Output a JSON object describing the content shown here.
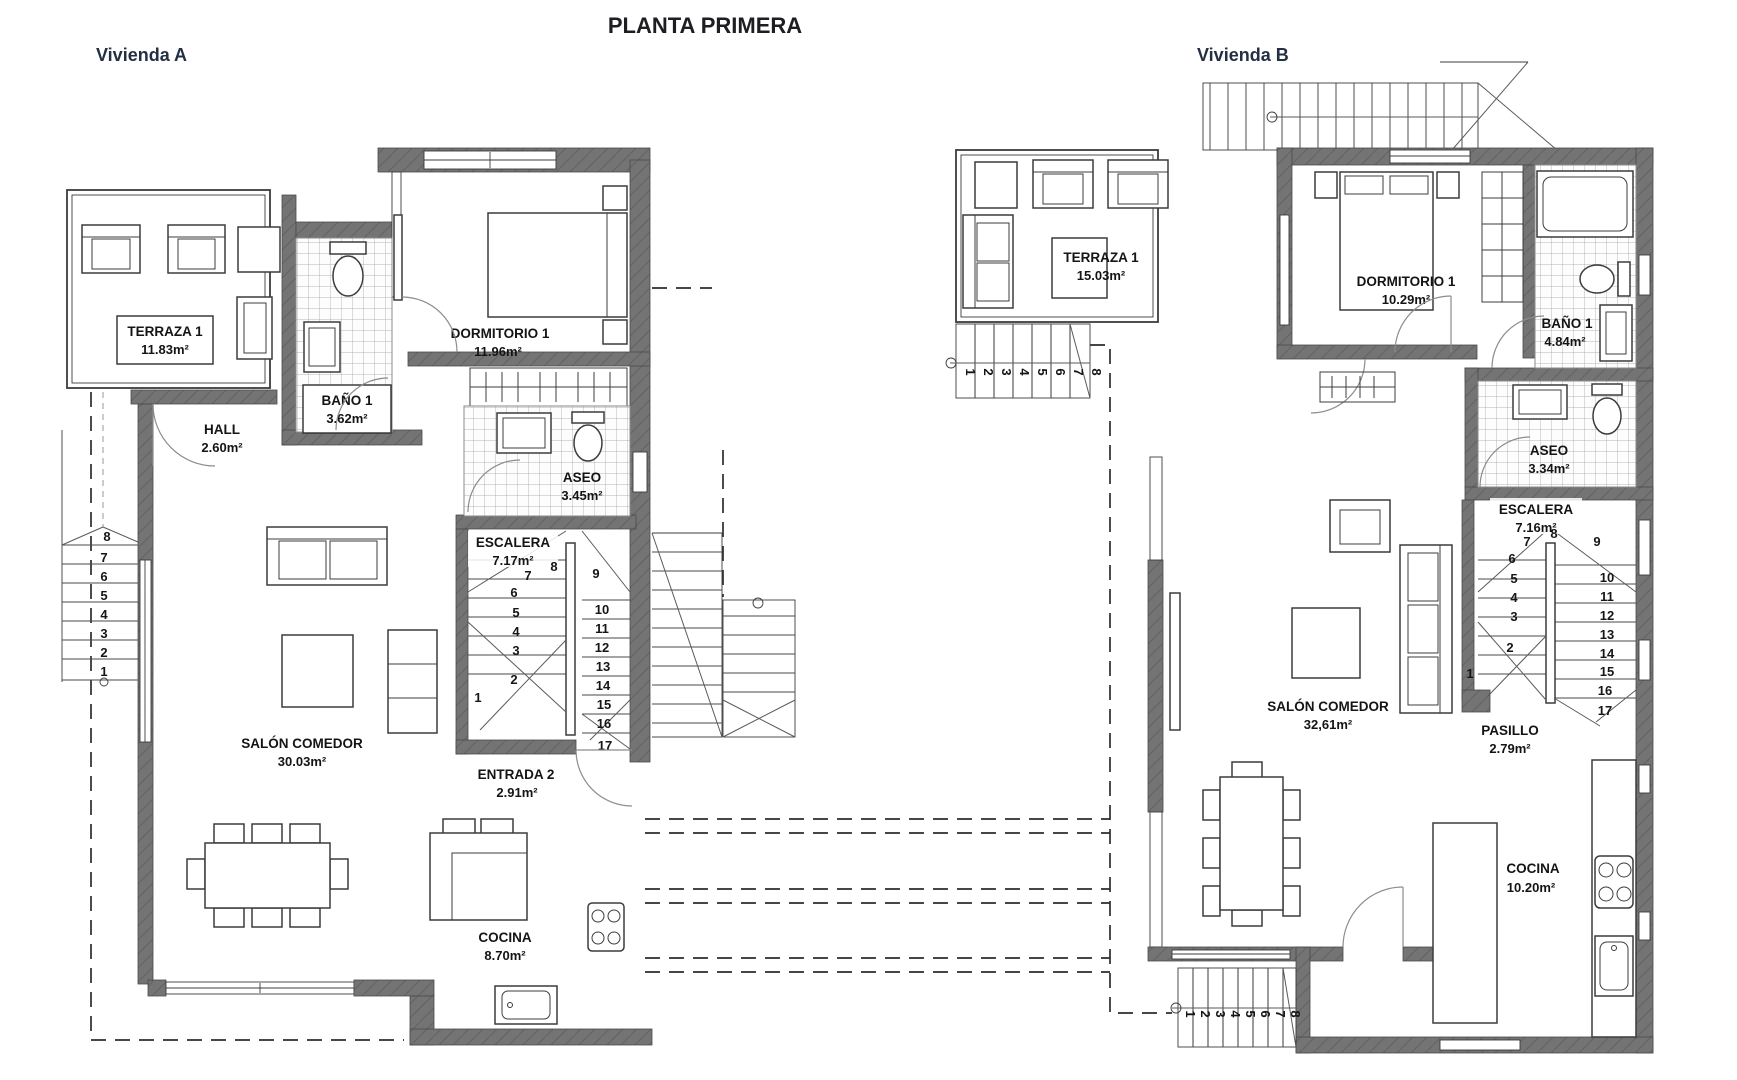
{
  "title": "PLANTA PRIMERA",
  "colors": {
    "wall": "#737373",
    "line": "#3c3c3c",
    "dwelling_label": "#233043"
  },
  "vivienda_a": {
    "name": "Vivienda A",
    "rooms": {
      "terraza": {
        "name": "TERRAZA 1",
        "area": "11.83m²"
      },
      "bano1": {
        "name": "BAÑO 1",
        "area": "3.62m²"
      },
      "dormitorio1": {
        "name": "DORMITORIO 1",
        "area": "11.96m²"
      },
      "hall": {
        "name": "HALL",
        "area": "2.60m²"
      },
      "aseo": {
        "name": "ASEO",
        "area": "3.45m²"
      },
      "escalera": {
        "name": "ESCALERA",
        "area": "7.17m²"
      },
      "salon_comedor": {
        "name": "SALÓN COMEDOR",
        "area": "30.03m²"
      },
      "entrada2": {
        "name": "ENTRADA 2",
        "area": "2.91m²"
      },
      "cocina": {
        "name": "COCINA",
        "area": "8.70m²"
      }
    },
    "stairs": {
      "interior": [
        "1",
        "2",
        "3",
        "4",
        "5",
        "6",
        "7",
        "8",
        "9",
        "10",
        "11",
        "12",
        "13",
        "14",
        "15",
        "16",
        "17"
      ],
      "exterior": [
        "1",
        "2",
        "3",
        "4",
        "5",
        "6",
        "7",
        "8"
      ]
    }
  },
  "vivienda_b": {
    "name": "Vivienda B",
    "rooms": {
      "terraza": {
        "name": "TERRAZA 1",
        "area": "15.03m²"
      },
      "dormitorio1": {
        "name": "DORMITORIO 1",
        "area": "10.29m²"
      },
      "bano1": {
        "name": "BAÑO 1",
        "area": "4.84m²"
      },
      "aseo": {
        "name": "ASEO",
        "area": "3.34m²"
      },
      "escalera": {
        "name": "ESCALERA",
        "area": "7.16m²"
      },
      "salon_comedor": {
        "name": "SALÓN COMEDOR",
        "area": "32,61m²"
      },
      "pasillo": {
        "name": "PASILLO",
        "area": "2.79m²"
      },
      "cocina": {
        "name": "COCINA",
        "area": "10.20m²"
      }
    },
    "stairs": {
      "interior": [
        "1",
        "2",
        "3",
        "4",
        "5",
        "6",
        "7",
        "8",
        "9",
        "10",
        "11",
        "12",
        "13",
        "14",
        "15",
        "16",
        "17"
      ],
      "terrace": [
        "1",
        "2",
        "3",
        "4",
        "5",
        "6",
        "7",
        "8"
      ],
      "exterior": [
        "1",
        "2",
        "3",
        "4",
        "5",
        "6",
        "7",
        "8"
      ]
    }
  }
}
